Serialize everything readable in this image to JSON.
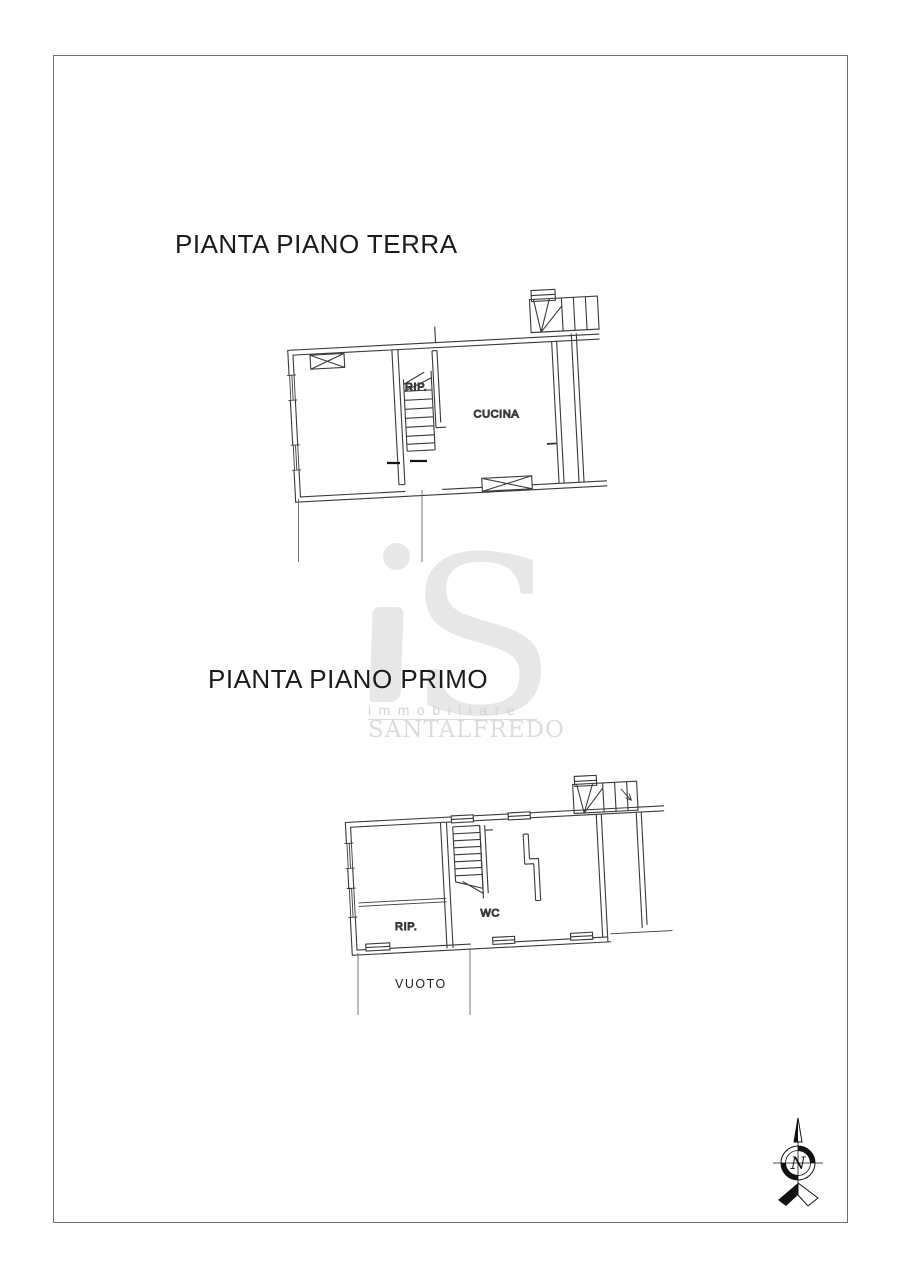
{
  "titles": {
    "terra": "PIANTA PIANO TERRA",
    "primo": "PIANTA PIANO PRIMO"
  },
  "plan_terra": {
    "labels": {
      "rip": "RIP.",
      "cucina": "CUCINA"
    }
  },
  "plan_primo": {
    "labels": {
      "rip": "RIP.",
      "wc": "WC",
      "vuoto": "VUOTO"
    }
  },
  "watermark": {
    "logo_i": "i",
    "logo_s": "S",
    "subtitle": "immobiliare",
    "brand": "SANTALFREDO"
  },
  "compass": {
    "north": "N"
  },
  "colors": {
    "page_border": "#6f6f6f",
    "drawing_line": "#3a3a3a",
    "watermark_logo": "#e7e7e7",
    "watermark_text": "#d4d4d4",
    "title_text": "#1b1b1b"
  }
}
